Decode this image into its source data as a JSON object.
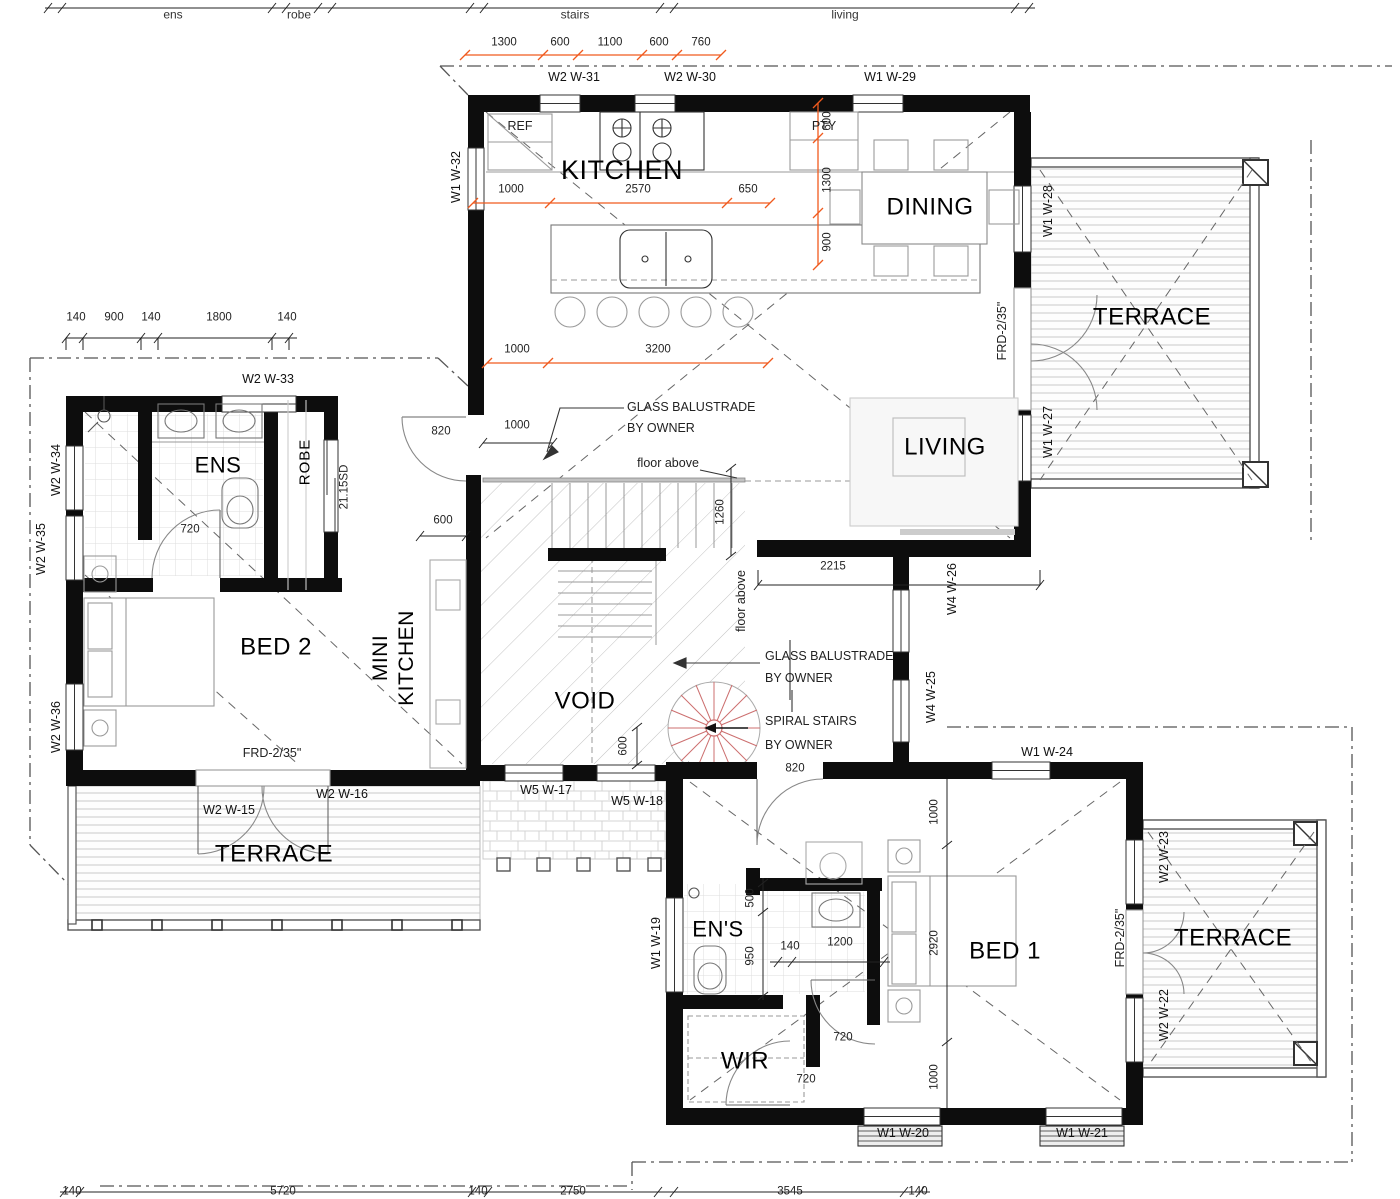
{
  "title": "Floor Plan",
  "colors": {
    "wall": "#0d0d0d",
    "dim_orange": "#f05a1e",
    "spiral_red": "#cc6f6f",
    "line_gray": "#999999"
  },
  "upper_spans": {
    "ens": "ens",
    "robe": "robe",
    "stairs": "stairs",
    "living": "living"
  },
  "rooms": {
    "kitchen": "KITCHEN",
    "dining": "DINING",
    "living": "LIVING",
    "terrace_ne": "TERRACE",
    "terrace_sw": "TERRACE",
    "terrace_se": "TERRACE",
    "ens": "ENS",
    "robe": "ROBE",
    "bed2": "BED 2",
    "mini_kitchen": "MINI KITCHEN",
    "void": "VOID",
    "ens2": "EN'S",
    "bed1": "BED 1",
    "wir": "WIR"
  },
  "fixtures": {
    "ref": "REF",
    "pty": "PTY"
  },
  "windows": {
    "w15": "W2 W-15",
    "w16": "W2 W-16",
    "w17": "W5 W-17",
    "w18": "W5 W-18",
    "w19": "W1 W-19",
    "w20": "W1 W-20",
    "w21": "W1 W-21",
    "w22": "W2 W-22",
    "w23": "W2 W-23",
    "w24": "W1 W-24",
    "w25": "W4 W-25",
    "w26": "W4 W-26",
    "w27": "W1 W-27",
    "w28": "W1 W-28",
    "w29": "W1 W-29",
    "w30": "W2 W-30",
    "w31": "W2 W-31",
    "w32": "W1 W-32",
    "w33": "W2 W-33",
    "w34": "W2 W-34",
    "w35": "W2 W-35",
    "w36": "W2 W-36"
  },
  "odims": {
    "t1": "1300",
    "t2": "600",
    "t3": "1100",
    "t4": "600",
    "t5": "760",
    "r1": "600",
    "r2": "1300",
    "r3": "900",
    "k1": "1000",
    "k2": "2570",
    "k3": "650",
    "l1": "1000",
    "l2": "3200"
  },
  "bdims": {
    "lc1": "140",
    "lc2": "900",
    "lc3": "140",
    "lc4": "1800",
    "lc5": "140",
    "entry": "820",
    "e1000": "1000",
    "mk600": "600",
    "v1260": "1260",
    "liv2215": "2215",
    "v600": "600",
    "hall820": "820",
    "ens720": "720",
    "sd": "21.15SD",
    "h500": "500",
    "h950": "950",
    "d140": "140",
    "d1200": "1200",
    "b1000a": "1000",
    "b2920": "2920",
    "b1000b": "1000",
    "wir720a": "720",
    "wir720b": "720",
    "bc1": "140",
    "bc2": "5720",
    "bc3": "140",
    "bc4": "2750",
    "bc5": "3545",
    "bc6": "140"
  },
  "notes": {
    "gb1a": "GLASS BALUSTRADE",
    "gb1b": "BY OWNER",
    "gb2a": "GLASS BALUSTRADE",
    "gb2b": "BY OWNER",
    "sp1": "SPIRAL STAIRS",
    "sp2": "BY OWNER",
    "fa_h": "floor above",
    "fa_v": "floor above",
    "frd_sw": "FRD-2/35\"",
    "frd_ne": "FRD-2/35\"",
    "frd_se": "FRD-2/35\""
  }
}
